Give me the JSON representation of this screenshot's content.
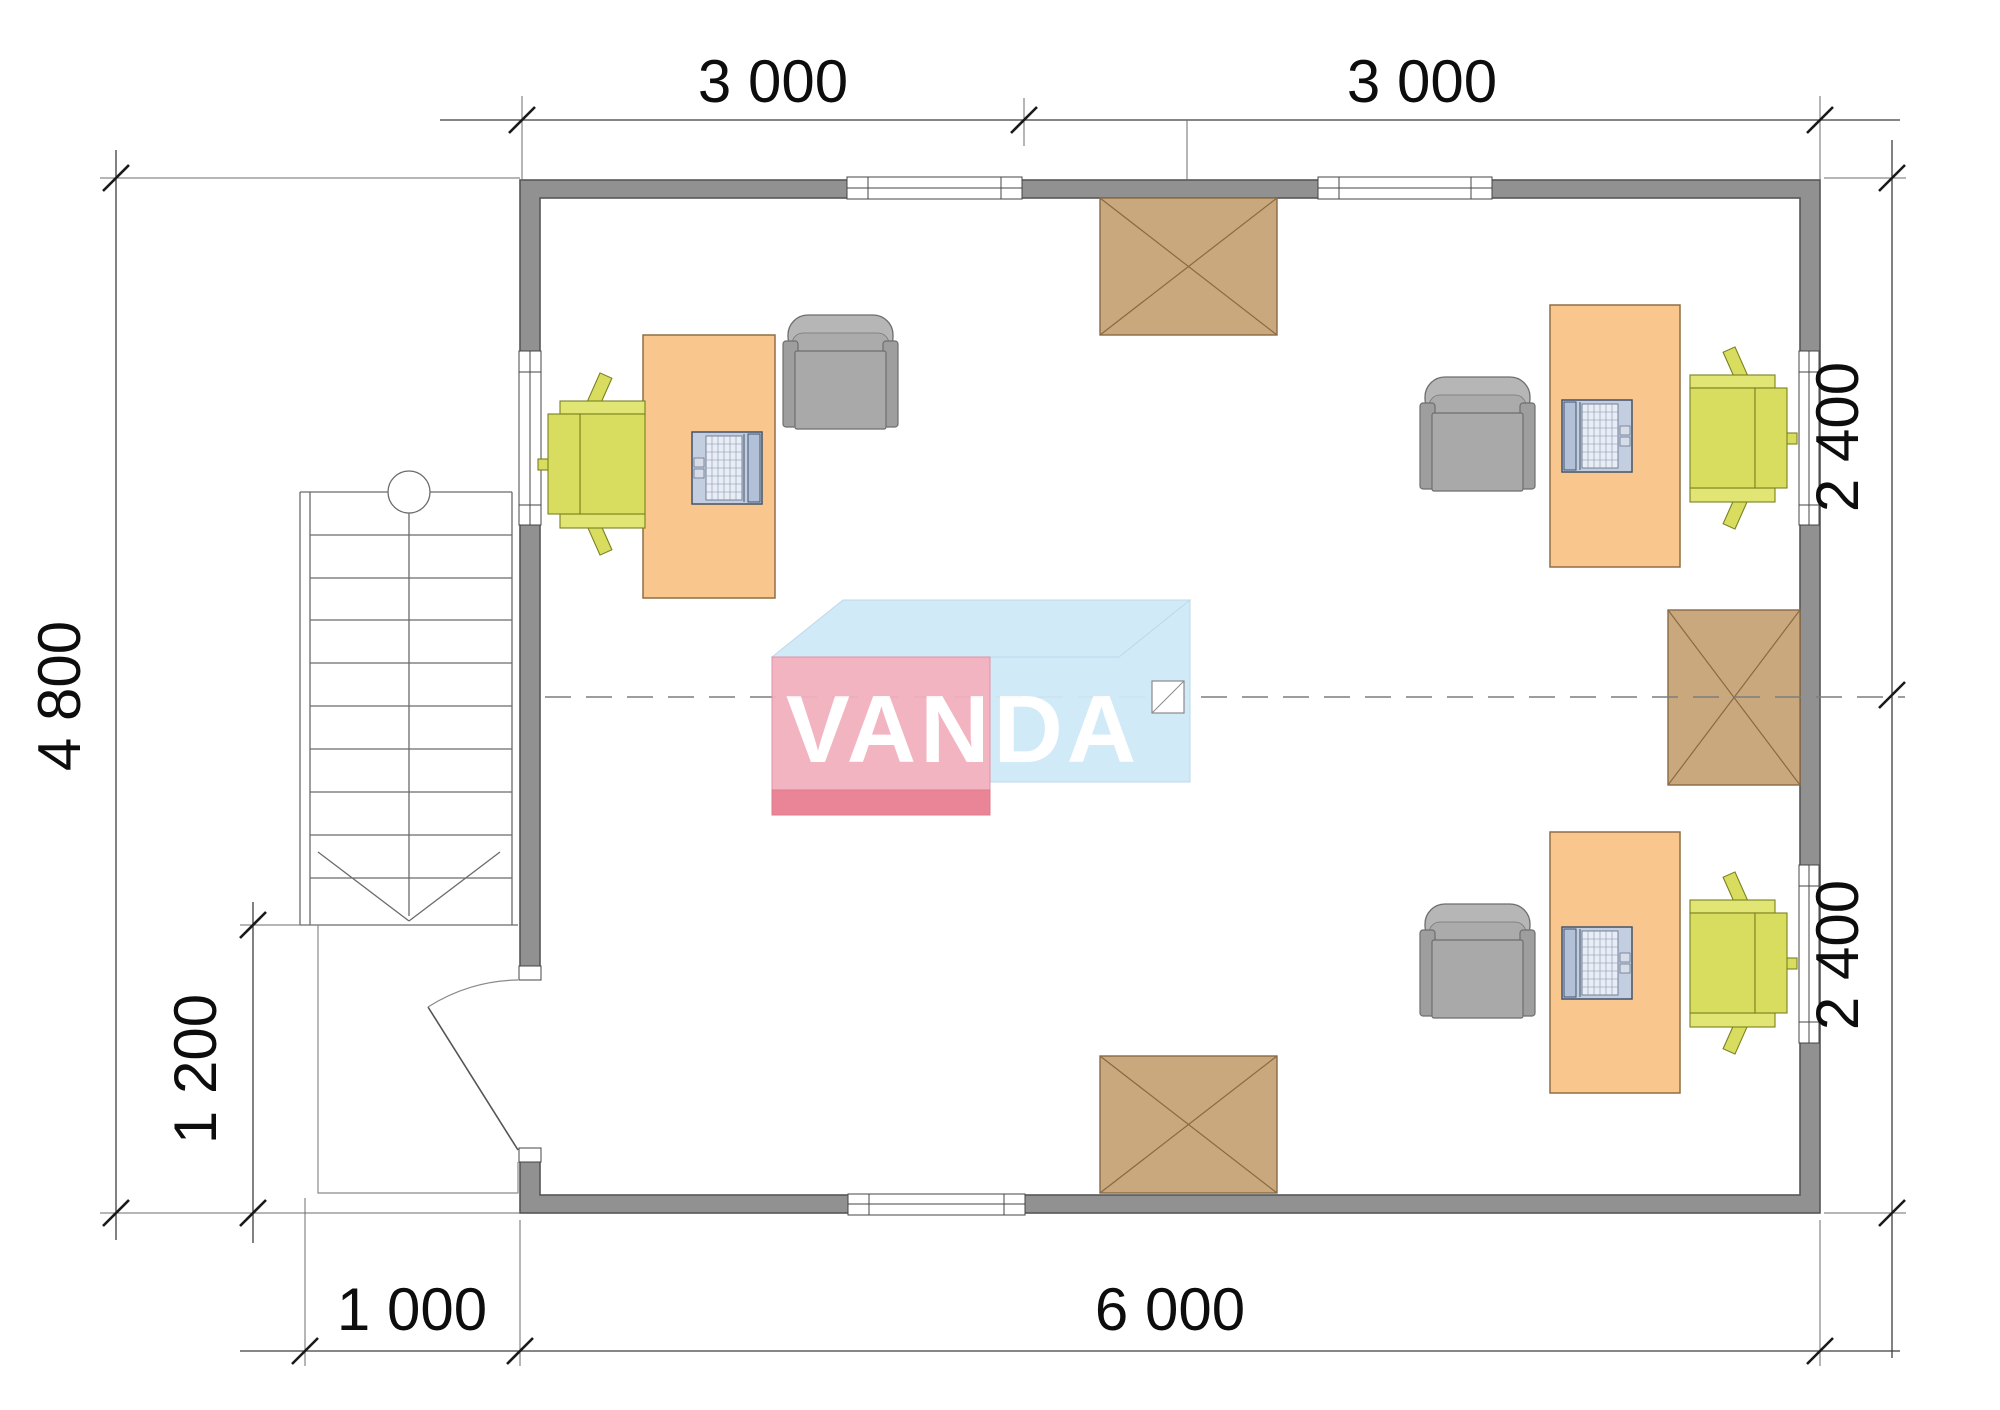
{
  "page": {
    "title": "Office floor plan"
  },
  "logo": {
    "text": "VANDA"
  },
  "dimensions": {
    "top": [
      "3 000",
      "3 000"
    ],
    "right": [
      "2 400",
      "2 400"
    ],
    "left_total": "4 800",
    "porch_height": "1 200",
    "porch_width": "1 000",
    "bottom_total": "6 000"
  },
  "colors": {
    "wall": "#919191",
    "desk": "#f9c68e",
    "task_chair": "#d8dd5f",
    "armchair": "#a9a9a9",
    "roof_hatch": "#c8a87c",
    "logo_pink": "#f3b0bf",
    "logo_red": "#e87f92",
    "logo_blue": "#cfe9f8"
  }
}
